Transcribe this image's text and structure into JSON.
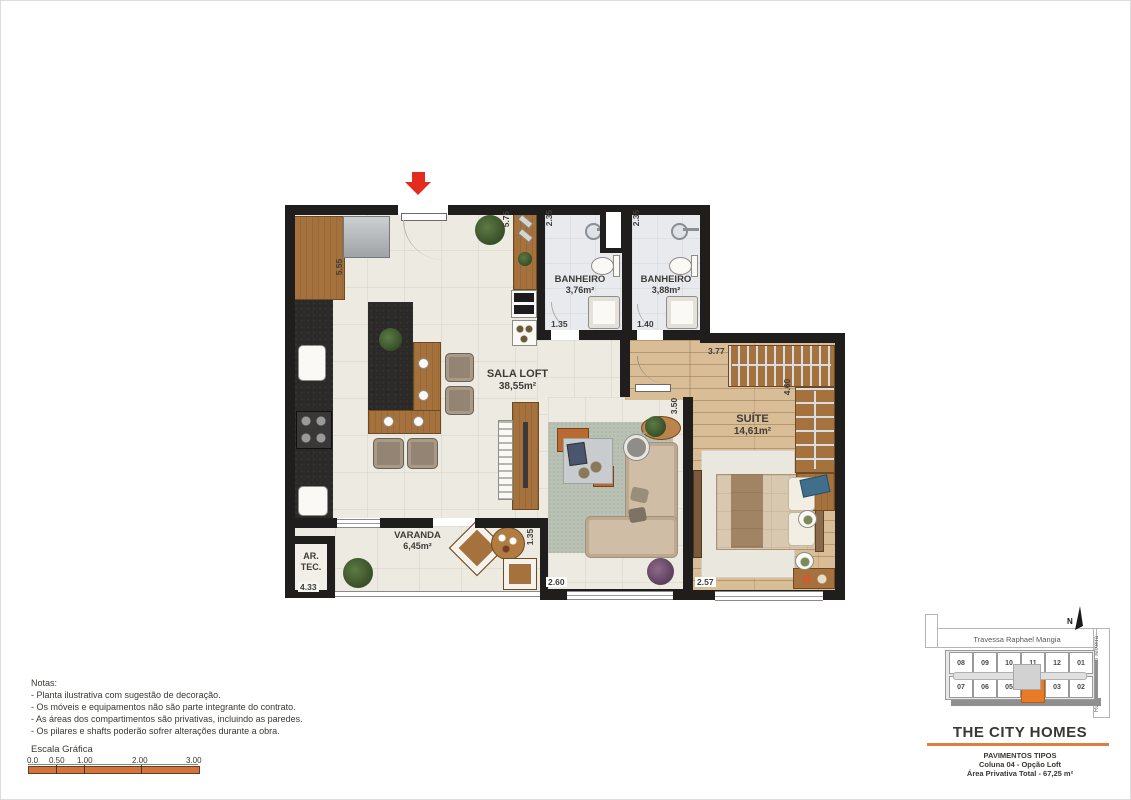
{
  "plan": {
    "rooms": {
      "sala": {
        "name": "SALA LOFT",
        "area": "38,55m²"
      },
      "banheiro1": {
        "name": "BANHEIRO",
        "area": "3,76m²"
      },
      "banheiro2": {
        "name": "BANHEIRO",
        "area": "3,88m²"
      },
      "suite": {
        "name": "SUÍTE",
        "area": "14,61m²"
      },
      "varanda": {
        "name": "VARANDA",
        "area": "6,45m²"
      },
      "artec": {
        "line1": "AR.",
        "line2": "TEC."
      }
    },
    "dimensions": {
      "kitchen_depth": "5.55",
      "entry_depth": "5.75",
      "bath1_depth": "2.35",
      "bath2_depth": "2.35",
      "bath1_width": "1.35",
      "bath2_width": "1.40",
      "closet_width": "3.77",
      "suite_depth": "4.60",
      "sala_suite_wall": "3.50",
      "varanda_right": "1.35",
      "living_width": "2.60",
      "suite_width": "2.57",
      "varanda_width": "4.33"
    }
  },
  "notes": {
    "title": "Notas:",
    "items": [
      "- Planta ilustrativa com sugestão de decoração.",
      "- Os móveis e equipamentos não são parte integrante do contrato.",
      "- As áreas dos compartimentos são privativas, incluindo as paredes.",
      "- Os pilares e shafts poderão sofrer alterações durante a obra."
    ]
  },
  "scale": {
    "title": "Escala Gráfica",
    "ticks": [
      "0.0",
      "0.50",
      "1.00",
      "2.00",
      "3.00"
    ]
  },
  "keyplan": {
    "north": "N",
    "street_top": "Travessa Raphael Mangia",
    "street_right": "Rua Pref. Sebastião Teixeira",
    "units_top": [
      "08",
      "09",
      "10",
      "11",
      "12",
      "01"
    ],
    "units_bottom": [
      "07",
      "06",
      "05",
      "04",
      "03",
      "02"
    ],
    "highlighted_unit": "04"
  },
  "titleblock": {
    "brand": "THE CITY HOMES",
    "line1": "PAVIMENTOS TIPOS",
    "line2": "Coluna 04 - Opção Loft",
    "line3": "Área Privativa Total - 67,25 m²"
  },
  "colors": {
    "accent_orange": "#dd7f3f",
    "highlight_orange": "#e87c26",
    "arrow_red": "#e32b1e",
    "wall": "#201e1c"
  }
}
